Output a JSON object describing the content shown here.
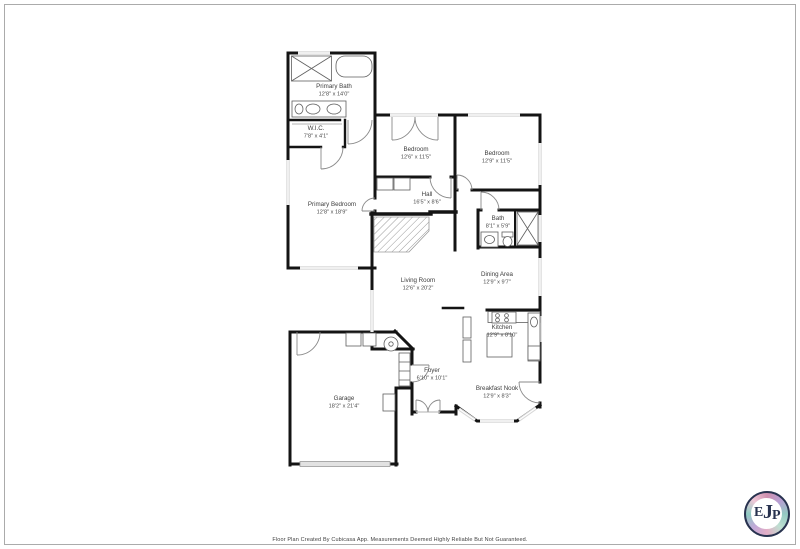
{
  "page": {
    "background": "#ffffff",
    "frame_border_color": "#ababab"
  },
  "floorplan": {
    "wall_color": "#141414",
    "window_color": "#d8d8d8",
    "door_color": "#8a8a8a",
    "fixture_color": "#5f5f5f",
    "label_color": "#3d3d3d",
    "rooms": [
      {
        "id": "primary-bath",
        "name": "Primary Bath",
        "dims": "12'8\" x 14'0\""
      },
      {
        "id": "wic",
        "name": "W.I.C.",
        "dims": "7'8\" x 4'1\""
      },
      {
        "id": "primary-bedroom",
        "name": "Primary Bedroom",
        "dims": "12'8\" x 18'9\""
      },
      {
        "id": "bedroom-1",
        "name": "Bedroom",
        "dims": "12'6\" x 11'5\""
      },
      {
        "id": "bedroom-2",
        "name": "Bedroom",
        "dims": "12'9\" x 11'5\""
      },
      {
        "id": "hall",
        "name": "Hall",
        "dims": "16'5\" x 8'6\""
      },
      {
        "id": "bath",
        "name": "Bath",
        "dims": "8'1\" x 5'9\""
      },
      {
        "id": "dining-area",
        "name": "Dining Area",
        "dims": "12'9\" x 9'7\""
      },
      {
        "id": "living-room",
        "name": "Living Room",
        "dims": "12'6\" x 20'2\""
      },
      {
        "id": "kitchen",
        "name": "Kitchen",
        "dims": "12'9\" x 8'10\""
      },
      {
        "id": "breakfast-nook",
        "name": "Breakfast Nook",
        "dims": "12'9\" x 8'3\""
      },
      {
        "id": "foyer",
        "name": "Foyer",
        "dims": "6'10\" x 10'1\""
      },
      {
        "id": "garage",
        "name": "Garage",
        "dims": "18'2\" x 21'4\""
      }
    ]
  },
  "footer": {
    "disclaimer": "Floor Plan Created By Cubicasa App. Measurements Deemed Highly Reliable But Not Guaranteed."
  },
  "logo": {
    "letter_e": "E",
    "letter_j": "J",
    "letter_p": "P",
    "text_color": "#28324f",
    "ring_colors": [
      "#cf8fae",
      "#b79fd4",
      "#93c9c2",
      "#bfe0d2",
      "#e3aec6",
      "#c1a8d8"
    ]
  }
}
